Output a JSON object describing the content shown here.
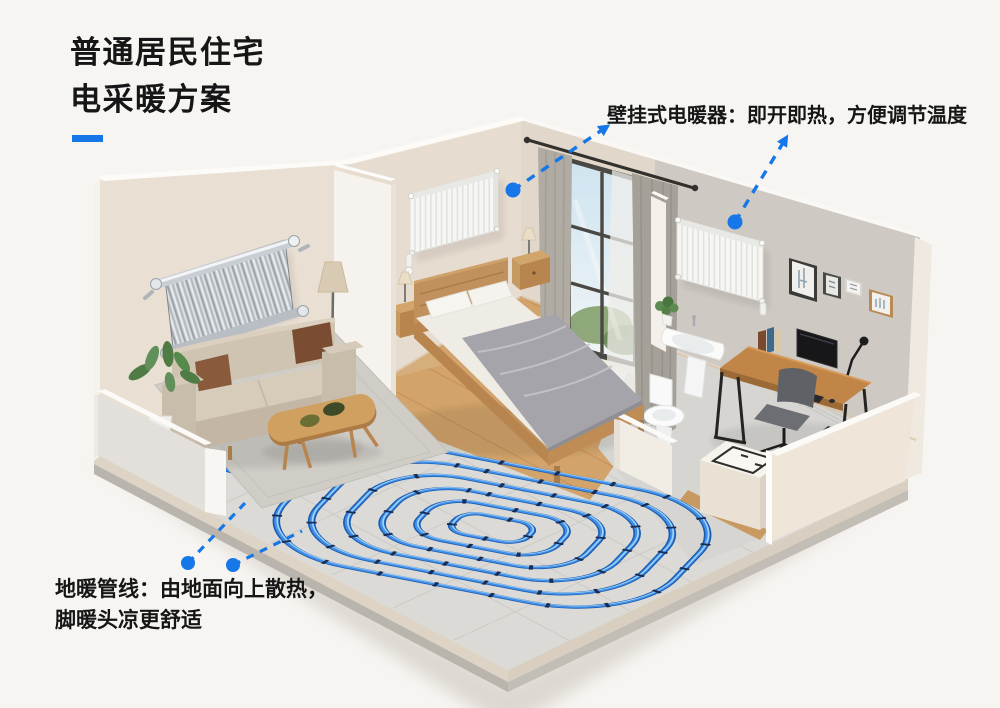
{
  "title": {
    "line1": "普通居民住宅",
    "line2": "电采暖方案"
  },
  "annotations": {
    "wall_heater": {
      "text": "壁挂式电暖器：即开即热，方便调节温度"
    },
    "floor_heating": {
      "line1": "地暖管线：由地面向上散热，",
      "line2": "脚暖头凉更舒适"
    }
  },
  "colors": {
    "accent_blue": "#1677e8",
    "pipe_blue": "#3f8ee9",
    "pipe_dark": "#1b5cb0",
    "pipe_highlight": "#a8d8ff",
    "pipe_clip_navy": "#1a2c50",
    "wall_beige": "#e8ddd1",
    "wall_gray": "#cfc9c3",
    "floor_gray": "#dbdad6",
    "wood_oak": "#cfa05f",
    "text_black": "#161616",
    "background": "#f7f5f2"
  }
}
